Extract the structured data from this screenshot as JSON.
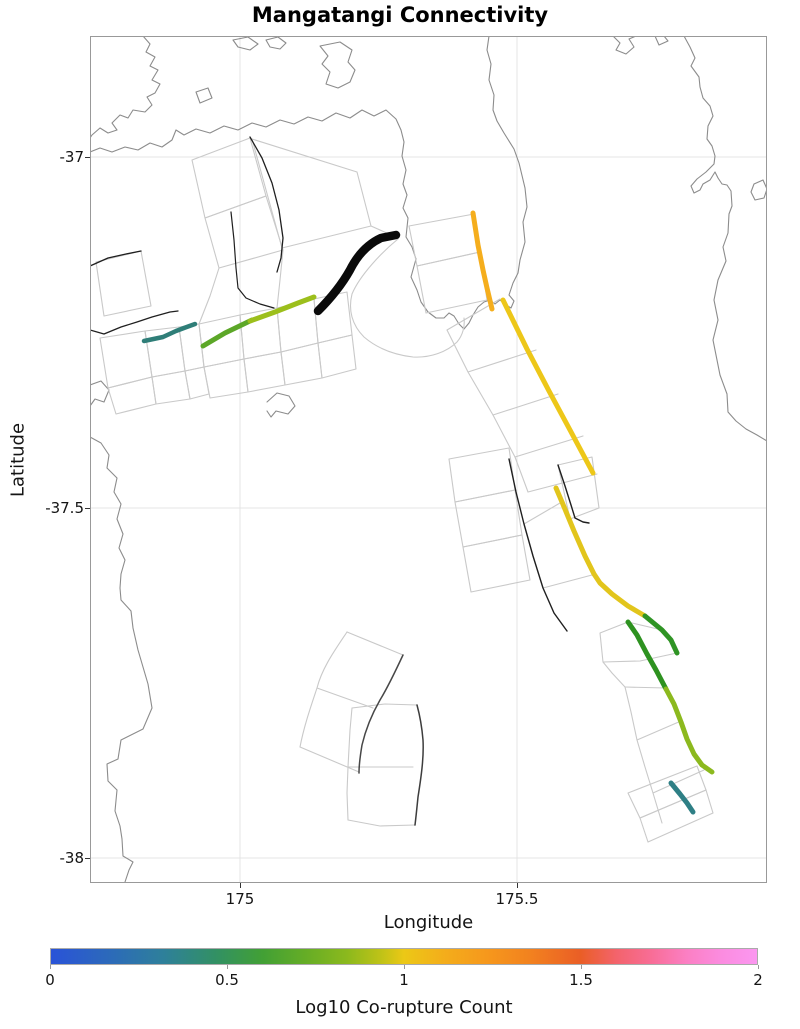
{
  "title": "Mangatangi Connectivity",
  "axes": {
    "xlabel": "Longitude",
    "ylabel": "Latitude",
    "xticks": [
      {
        "label": "175",
        "px": 240
      },
      {
        "label": "175.5",
        "px": 517
      }
    ],
    "yticks": [
      {
        "label": "-37",
        "px": 157
      },
      {
        "label": "-37.5",
        "px": 508
      },
      {
        "label": "-38",
        "px": 858
      }
    ],
    "xlim": [
      174.73,
      175.95
    ],
    "ylim": [
      -38.03,
      -36.83
    ]
  },
  "colorbar": {
    "label": "Log10 Co-rupture Count",
    "vmin": 0,
    "vmax": 2,
    "ticks": [
      {
        "label": "0",
        "frac": 0
      },
      {
        "label": "0.5",
        "frac": 0.25
      },
      {
        "label": "1",
        "frac": 0.5
      },
      {
        "label": "1.5",
        "frac": 0.75
      },
      {
        "label": "2",
        "frac": 1
      }
    ],
    "gradient": [
      [
        0,
        "#2a53d8"
      ],
      [
        0.08,
        "#2c69bb"
      ],
      [
        0.16,
        "#2e809a"
      ],
      [
        0.24,
        "#33925f"
      ],
      [
        0.3,
        "#42a035"
      ],
      [
        0.36,
        "#65ad26"
      ],
      [
        0.42,
        "#8cb91d"
      ],
      [
        0.47,
        "#c2c317"
      ],
      [
        0.5,
        "#ecc816"
      ],
      [
        0.56,
        "#f4ac1b"
      ],
      [
        0.62,
        "#f6971c"
      ],
      [
        0.68,
        "#f2811f"
      ],
      [
        0.75,
        "#ea5e26"
      ],
      [
        0.8,
        "#f3636b"
      ],
      [
        0.85,
        "#f86d96"
      ],
      [
        0.9,
        "#fb7fc3"
      ],
      [
        0.95,
        "#fb8ce0"
      ],
      [
        1,
        "#fb97f0"
      ]
    ]
  },
  "chart_data": {
    "type": "map",
    "title": "Mangatangi Connectivity",
    "xlabel": "Longitude",
    "ylabel": "Latitude",
    "colorbar_label": "Log10 Co-rupture Count",
    "colorbar_range": [
      0,
      2
    ],
    "plot_px": {
      "left": 90,
      "top": 36,
      "right": 767,
      "bottom": 883
    },
    "gridlines_px": {
      "x": [
        240,
        517
      ],
      "y": [
        157,
        508,
        858
      ]
    },
    "style": {
      "grid": "#e4e4e4",
      "coast": "#8c8c8c",
      "outline": "#c9c9c9",
      "dark_trace": "#1f1f1f",
      "border": "#999999"
    },
    "coastlines": [
      "M143,36 L150,44 146,52 155,57 150,66 158,70 152,80 160,84 155,93 147,97 152,105 145,112 133,110 128,118 120,115 112,123 117,130 108,133 100,128 92,135 90,138",
      "M90,152 L100,148 112,152 125,147 138,150 150,143 162,147 172,140 176,130 184,135 196,129 210,133 224,126 238,130 252,123 266,127 280,120 294,124 308,117 322,121 336,113 350,118 362,110 374,116 386,110 396,119 401,130 404,142 402,156 406,170 403,184 407,195 403,208 408,218 406,237 412,247 416,259 411,277 417,290 421,302 428,312 436,318 444,318 449,313 454,316 459,324 464,329 469,323 473,315 478,307 484,302 490,300 495,304 500,300 506,305 511,308 514,301 509,295 513,283 518,273 520,260 525,242 523,222 527,207 525,188 519,163 514,149 504,133 497,121 493,110 494,95 489,80 491,64 487,50 489,36",
      "M90,437 L101,443 109,455 107,468 117,478 114,492 121,504 117,519 123,534 119,548 125,560 121,574 120,588 121,600 131,611 133,628 138,650 148,684 152,708 143,729 121,740 118,759 107,764 108,781 117,790 115,811 120,826 122,839 123,856 133,862 129,870 125,882",
      "M684,36 L690,47 695,58 691,66 699,77 700,87 703,98 710,106 713,116 708,126 707,139 712,146 715,156 714,164 706,172 697,179 691,186 694,193 700,190 703,184 710,180 715,172 718,178 722,184 727,185 731,191 732,206 729,214 728,233 723,247 726,261 718,280 714,300 718,320 713,340 717,360 720,375 727,394 728,412 736,421 746,429 757,435 767,441",
      "M320,46 L340,42 352,50 348,62 355,70 350,82 338,88 326,84 330,72 322,64 328,56 Z",
      "M266,40 L278,37 286,43 280,49 270,47 Z",
      "M233,40 L248,37 258,44 250,50 238,47 Z",
      "M196,92 L208,88 212,98 200,103 Z",
      "M613,36 L620,43 616,50 626,54 634,47 629,39 636,36",
      "M655,36 L659,45 668,41 664,36",
      "M754,184 L763,180 767,189 764,198 755,200 751,192 Z",
      "M90,385 L101,381 109,390 104,402 95,399 90,406",
      "M267,402 L277,393 289,396 295,406 288,414 276,411 271,417 267,411"
    ],
    "fault_outlines": [
      "M96,262 L141,251 151,306 104,316 Z",
      "M192,160 L250,138 266,196 205,218 Z",
      "M205,218 L266,196 283,250 219,268 Z",
      "M252,139 L357,172 371,226 282,248 Z",
      "M371,226 L398,238",
      "M219,268 L210,296 199,324",
      "M283,250 L280,280 277,308",
      "M100,338 L145,331 152,377 108,388 Z",
      "M145,331 L179,327 185,371 152,377 Z",
      "M179,327 L199,324 204,367 185,371 Z",
      "M108,388 L152,377 156,404 116,414 Z",
      "M152,377 L185,371 190,399 156,404 Z",
      "M185,371 L204,367 209,394 190,399 Z",
      "M199,324 L240,315 244,359 204,367 Z",
      "M240,315 L277,308 281,352 244,359 Z",
      "M204,367 L244,359 248,392 210,398 Z",
      "M244,359 L281,352 285,385 248,392 Z",
      "M277,308 L314,299 318,343 281,352 Z",
      "M314,299 L347,292 352,335 318,343 Z",
      "M281,352 L318,343 322,378 285,385 Z",
      "M318,343 L352,335 356,369 322,378 Z",
      "M409,226 L474,214 480,252 417,266 Z",
      "M417,266 L480,252 487,300 426,313 Z",
      "M398,239 C382,252 360,275 352,294 C348,310 352,325 364,337 C378,349 396,355 413,357 C430,358 447,352 457,342 C463,335 465,326 464,318",
      "M447,330 L468,372 493,415 515,457 528,492",
      "M447,330 L500,299",
      "M468,372 L536,350",
      "M493,415 L558,394",
      "M515,457 L583,436",
      "M528,492 L597,474",
      "M449,459 L509,448 515,490 455,502 Z",
      "M455,502 L515,490 522,535 463,547 Z",
      "M463,547 L522,535 530,580 471,592 Z",
      "M558,465 L592,457 599,508 570,519 Z",
      "M524,524 L560,503",
      "M543,588 L592,575",
      "M600,633 L628,622 662,630 677,653 640,661 603,662 Z",
      "M603,662 L612,673 625,687 631,712 637,740 645,767 653,793 662,823",
      "M625,687 L666,688",
      "M637,740 L681,721",
      "M653,793 L704,770",
      "M628,793 L697,766 706,790 640,818 Z",
      "M640,818 L706,790 713,813 648,842 Z",
      "M347,632 L403,655",
      "M347,632 C335,650 322,668 317,688 C311,706 304,726 300,747",
      "M317,688 L373,708",
      "M300,747 L359,772",
      "M352,708 L385,704 417,705",
      "M348,767 L413,767",
      "M352,708 L350,730 348,767 347,793 348,820",
      "M348,820 L380,826 415,825"
    ],
    "dark_traces": [
      {
        "d": "M90,266 L108,258 126,254 141,251",
        "w": 1.3
      },
      {
        "d": "M90,330 L104,334 121,327 137,322 152,317 170,312 178,311",
        "w": 1.3
      },
      {
        "d": "M250,137 L262,158 272,183 279,210 283,238 281,258 277,272",
        "w": 1.3
      },
      {
        "d": "M231,212 L234,240 236,268 238,288 246,298 260,304 274,308",
        "w": 1.2
      },
      {
        "d": "M509,459 L516,492 524,524 533,556 543,588 554,613 567,631",
        "w": 1.4
      },
      {
        "d": "M558,465 L565,486 571,505 575,518 583,522 589,523",
        "w": 1.4
      },
      {
        "d": "M403,655 C396,670 388,687 380,700 C372,714 366,728 362,745 C360,757 359,765 359,773",
        "w": 1.5,
        "color": "#474747"
      },
      {
        "d": "M417,705 C420,716 422,728 423,740 C424,758 421,778 418,797 C417,807 416,817 415,825",
        "w": 1.5,
        "color": "#3d3d3d"
      }
    ],
    "colored_traces": [
      {
        "name": "teal-trace-west",
        "color": "#2f7e78",
        "w": 4.5,
        "value_log10": 0.2,
        "d": "M144,341 L163,337 176,331 184,328 195,324"
      },
      {
        "name": "olive-trace-west-1",
        "color": "#5ca728",
        "w": 5,
        "value_log10": 0.45,
        "d": "M203,346 L225,333 252,320"
      },
      {
        "name": "olive-trace-west-2",
        "color": "#9cbf1c",
        "w": 5,
        "value_log10": 0.65,
        "d": "M250,321 L275,312 298,303 314,297"
      },
      {
        "name": "thick-black-fault",
        "color": "#0a0a0a",
        "w": 8.5,
        "value_log10": null,
        "d": "M318,311 C330,299 341,286 350,270 C358,254 368,244 381,238 L396,235"
      },
      {
        "name": "orange-trace-north",
        "color": "#f5ae1d",
        "w": 5,
        "value_log10": 1.15,
        "d": "M473,213 L478,245 483,270 487,288 492,309"
      },
      {
        "name": "yellow-trace-mid",
        "color": "#edc719",
        "w": 5,
        "value_log10": 1.0,
        "d": "M503,300 L527,349 549,391 570,430 593,473"
      },
      {
        "name": "yellow-trace-south",
        "color": "#e2c51c",
        "w": 5,
        "value_log10": 0.95,
        "d": "M556,488 L562,502 574,531 585,556 594,574 600,583 612,594 628,606 645,616"
      },
      {
        "name": "green-hook-trace",
        "color": "#2f9424",
        "w": 5,
        "value_log10": 0.4,
        "d": "M645,616 L662,630 671,640 677,653"
      },
      {
        "name": "green-trace-long",
        "color": "#2e9220",
        "w": 5,
        "value_log10": 0.38,
        "d": "M628,622 L637,635 647,654 656,670 666,689"
      },
      {
        "name": "yellowgreen-trace-long",
        "color": "#8cb91e",
        "w": 5,
        "value_log10": 0.62,
        "d": "M666,689 L674,704 681,722 687,739 694,754 702,765 712,772"
      },
      {
        "name": "teal-trace-south",
        "color": "#2e7f85",
        "w": 5,
        "value_log10": 0.22,
        "d": "M671,783 L680,794 687,803 693,812"
      }
    ]
  }
}
